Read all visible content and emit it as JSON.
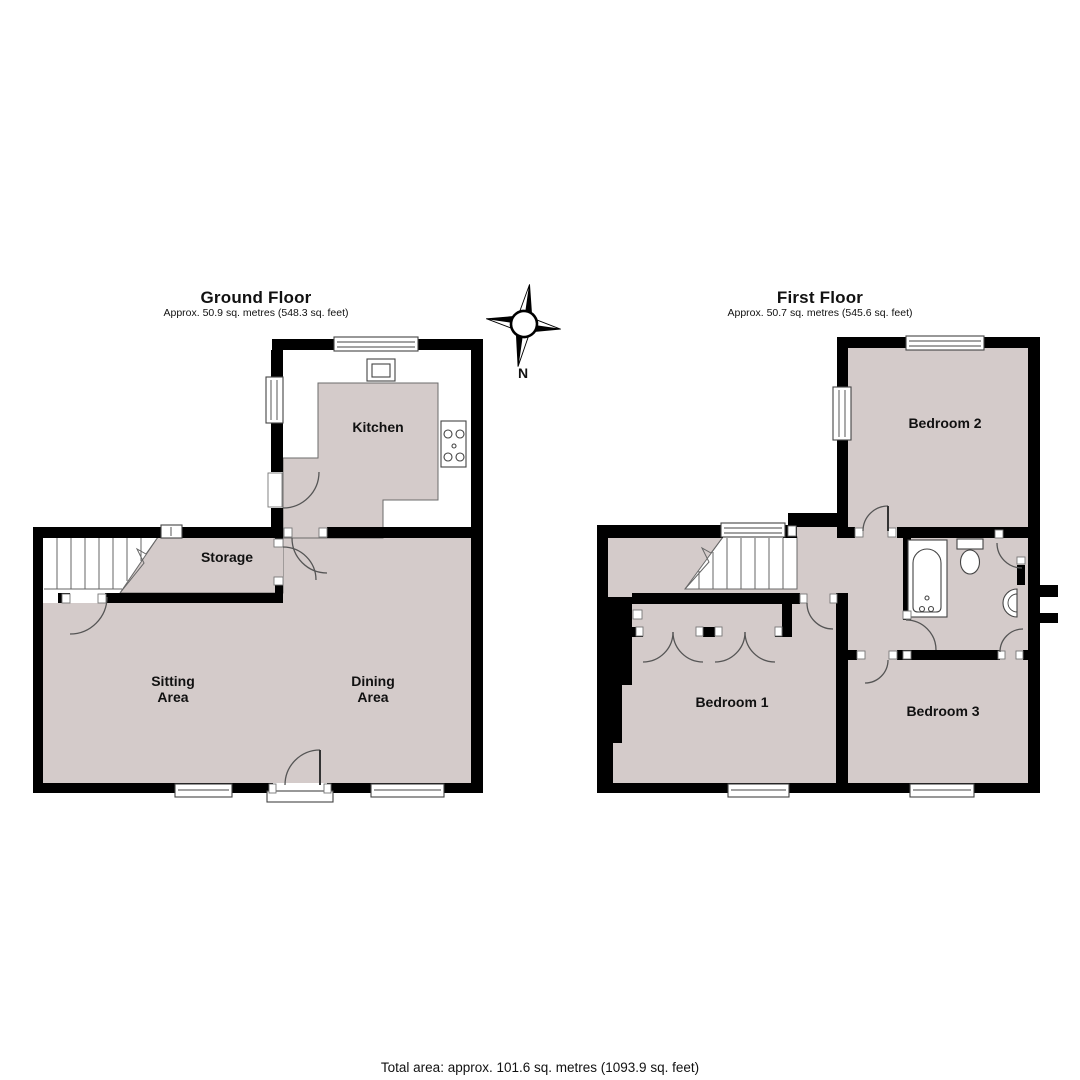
{
  "colors": {
    "floor_fill": "#d4cbca",
    "wall_fill": "#000000",
    "detail_line": "#555555",
    "label_color": "#111111",
    "background": "#ffffff"
  },
  "ground_floor": {
    "title": "Ground Floor",
    "subtitle": "Approx. 50.9 sq. metres (548.3 sq. feet)",
    "rooms": {
      "kitchen": "Kitchen",
      "storage": "Storage",
      "sitting": [
        "Sitting",
        "Area"
      ],
      "dining": [
        "Dining",
        "Area"
      ]
    }
  },
  "first_floor": {
    "title": "First Floor",
    "subtitle": "Approx. 50.7 sq. metres (545.6 sq. feet)",
    "rooms": {
      "bedroom1": "Bedroom 1",
      "bedroom2": "Bedroom 2",
      "bedroom3": "Bedroom 3"
    }
  },
  "compass": {
    "north_label": "N"
  },
  "footer": {
    "total_area": "Total area: approx. 101.6 sq. metres (1093.9 sq. feet)"
  }
}
